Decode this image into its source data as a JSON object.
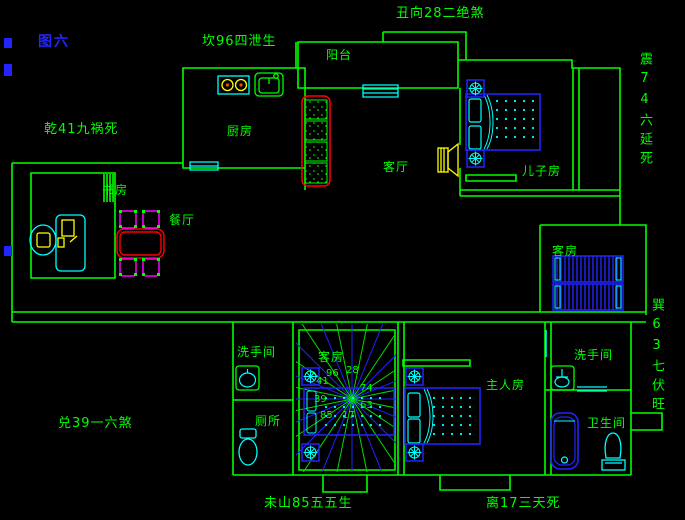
{
  "figure_label": "图六",
  "annotations": {
    "top_left": "坎96四泄生",
    "top_center": "丑向28二绝煞",
    "left_upper": "乾41九祸死",
    "right_upper": "震74六延死",
    "right_lower": "巽63七伏旺",
    "left_lower": "兑39一六煞",
    "bottom_left": "未山85五五生",
    "bottom_right": "离17三天死"
  },
  "rooms": {
    "balcony": "阳台",
    "kitchen": "厨房",
    "living_room": "客厅",
    "sons_room": "儿子房",
    "study": "书房",
    "dining": "餐厅",
    "guest_room_right": "客房",
    "guest_room_center": "客房",
    "washroom_left": "洗手间",
    "toilet_left": "厕所",
    "master_room": "主人房",
    "washroom_right": "洗手间",
    "bathroom_right": "卫生间"
  },
  "luopan": {
    "n": "96",
    "ne": "28",
    "e": "74",
    "se": "63",
    "s": "17",
    "sw": "85",
    "w": "39",
    "nw": "41"
  },
  "colors": {
    "wall_green": "#00FF00",
    "fixture_cyan": "#00FFFF",
    "furniture_blue": "#2222FF",
    "accent_yellow": "#FFFF00",
    "sofa_red": "#FF0000",
    "chair_magenta": "#FF00FF",
    "figure_label_blue": "#2424FF",
    "background": "#000000"
  }
}
